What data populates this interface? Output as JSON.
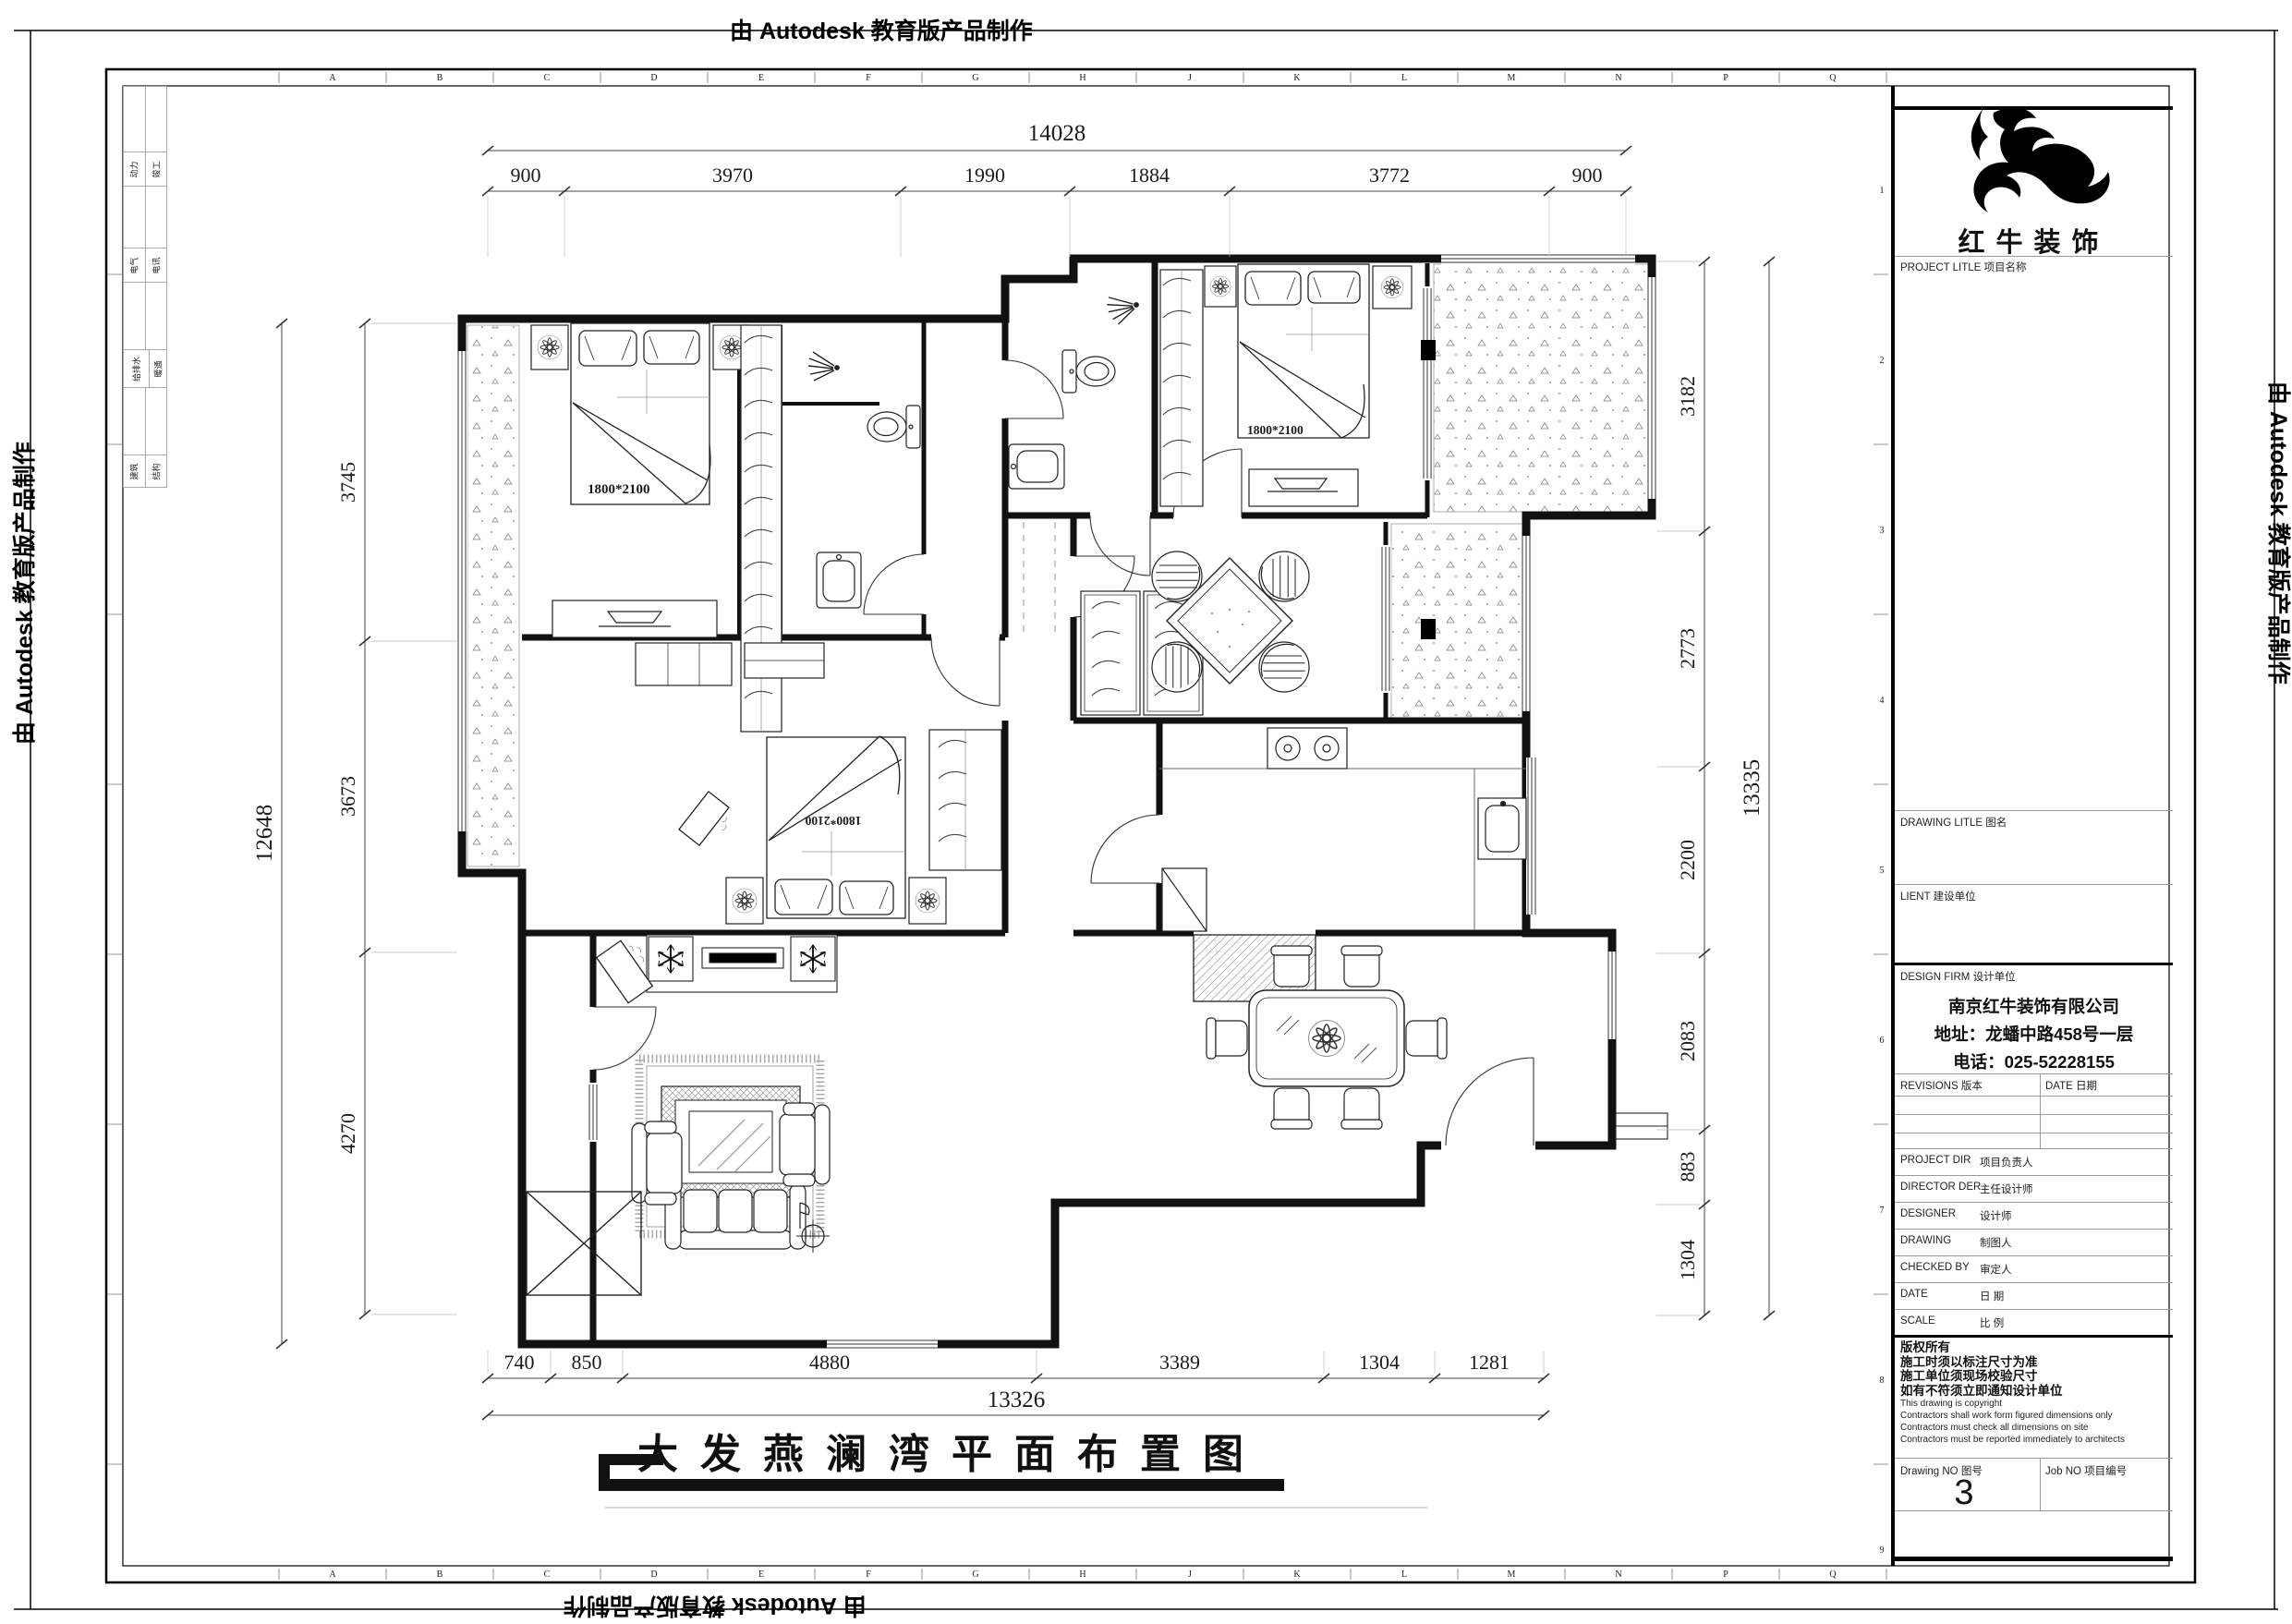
{
  "stamp": {
    "text": "由 Autodesk 教育版产品制作"
  },
  "drawing": {
    "title": "大发燕澜湾平面布置图",
    "bed_size_label": "1800*2100"
  },
  "dims": {
    "top": {
      "total": "14028",
      "segments": [
        "900",
        "3970",
        "1990",
        "1884",
        "3772",
        "900"
      ]
    },
    "left": {
      "total": "12648",
      "segments": [
        "3745",
        "3673",
        "4270"
      ]
    },
    "right": {
      "total": "13335",
      "segments": [
        "3182",
        "2773",
        "2200",
        "2083",
        "883",
        "1304"
      ]
    },
    "bottom": {
      "total": "13326",
      "segments": [
        "740",
        "850",
        "4880",
        "3389",
        "1304",
        "1281"
      ]
    }
  },
  "grid": {
    "letters": [
      "A",
      "B",
      "C",
      "D",
      "E",
      "F",
      "G",
      "H",
      "J",
      "K",
      "L",
      "M",
      "N",
      "P",
      "Q"
    ],
    "numbers": [
      "1",
      "2",
      "3",
      "4",
      "5",
      "6",
      "7",
      "8",
      "9"
    ]
  },
  "signoff": {
    "rows": [
      [
        "动力",
        "竣工"
      ],
      [
        "电气",
        "电讯"
      ],
      [
        "给排水",
        "暖通"
      ],
      [
        "建筑",
        "结构"
      ]
    ]
  },
  "title_block": {
    "brand": "红牛装饰",
    "project_label": "PROJECT LITLE  项目名称",
    "drawing_label": "DRAWING LITLE  图名",
    "client_label": "LIENT  建设单位",
    "firm_label": "DESIGN FIRM  设计单位",
    "company_name": "南京红牛装饰有限公司",
    "company_address": "地址：龙蟠中路458号一层",
    "company_phone": "电话：025-52228155",
    "revisions_label": "REVISIONS  版本",
    "revisions_date_label": "DATE  日期",
    "staff_rows": [
      {
        "en": "PROJECT DIR",
        "zh": "项目负责人"
      },
      {
        "en": "DIRECTOR DER",
        "zh": "主任设计师"
      },
      {
        "en": "DESIGNER",
        "zh": "设计师"
      },
      {
        "en": "DRAWING",
        "zh": "制图人"
      },
      {
        "en": "CHECKED BY",
        "zh": "审定人"
      },
      {
        "en": "DATE",
        "zh": "日  期"
      },
      {
        "en": "SCALE",
        "zh": "比  例"
      }
    ],
    "copyright_lines": [
      "版权所有",
      "施工时须以标注尺寸为准",
      "施工单位须现场校验尺寸",
      "如有不符须立即通知设计单位",
      "This drawing is copyright",
      "Contractors shall work form figured dimensions only",
      "Contractors must check all dimensions on site",
      "Contractors must be reported immediately to architects"
    ],
    "drawing_no_label": "Drawing NO  图号",
    "drawing_no": "3",
    "job_no_label": "Job NO  项目编号"
  }
}
